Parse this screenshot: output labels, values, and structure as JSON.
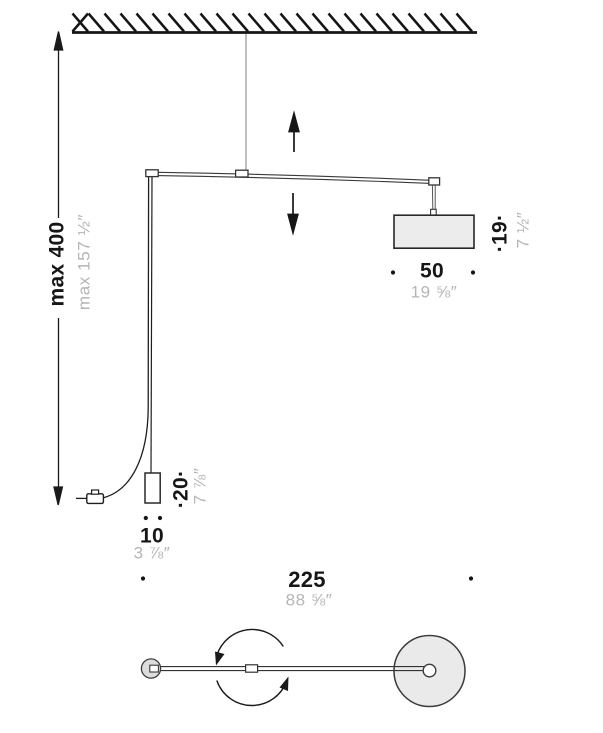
{
  "diagram": {
    "name": "suspension-lamp-dimension-drawing",
    "views": [
      "front-elevation",
      "top-plan"
    ]
  },
  "dimensions": {
    "overall_height": {
      "metric": "max 400",
      "imperial": "max 157 ½″"
    },
    "shade_width": {
      "metric": "50",
      "imperial": "19 ⅝″"
    },
    "shade_height": {
      "metric": "·19·",
      "imperial": "7 ½″"
    },
    "counterweight_height": {
      "metric": "·20·",
      "imperial": "7 ⅞″"
    },
    "counterweight_width": {
      "metric": "10",
      "imperial": "3 ⅞″"
    },
    "arm_length": {
      "metric": "225",
      "imperial": "88 ⅝″"
    }
  },
  "icons": {
    "movement": "up-down arrows",
    "rotation": "circular counterclockwise arrows"
  },
  "colors": {
    "line": "#1a1a1a",
    "secondary_text": "#b4b5b7",
    "shade_fill": "#ececec",
    "disc_fill": "#eaeaea"
  }
}
